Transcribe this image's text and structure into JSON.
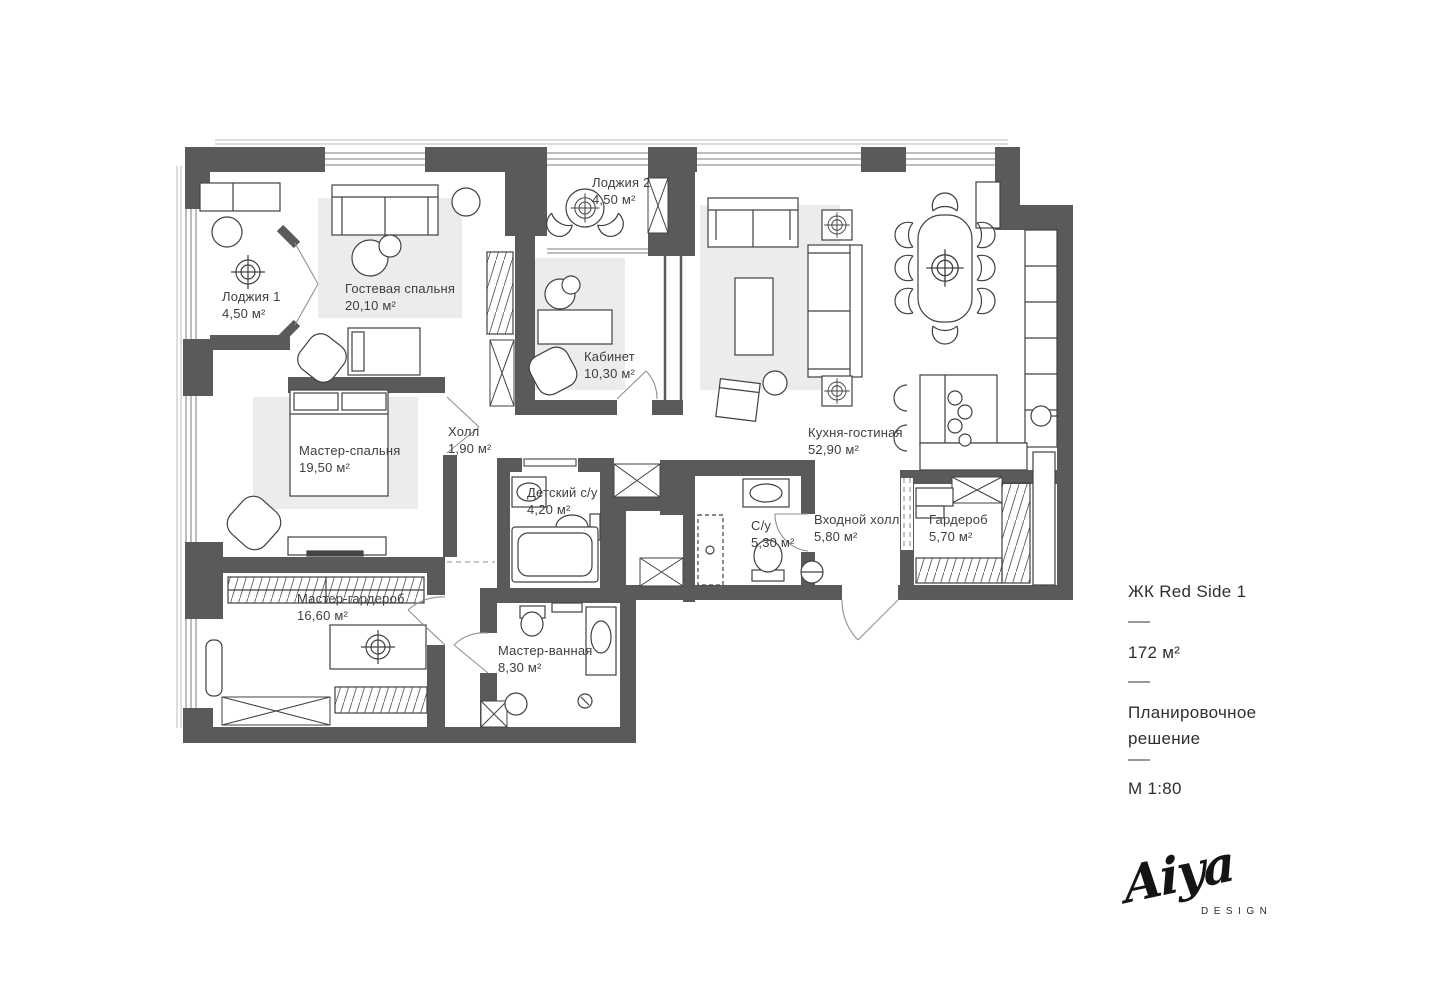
{
  "plan": {
    "rooms": [
      {
        "id": "loggia1",
        "name": "Лоджия 1",
        "area": "4,50 м²"
      },
      {
        "id": "guest_bedroom",
        "name": "Гостевая спальня",
        "area": "20,10 м²"
      },
      {
        "id": "loggia2",
        "name": "Лоджия 2",
        "area": "4,50 м²"
      },
      {
        "id": "office",
        "name": "Кабинет",
        "area": "10,30 м²"
      },
      {
        "id": "kitchen_living",
        "name": "Кухня-гостиная",
        "area": "52,90 м²"
      },
      {
        "id": "master_bedroom",
        "name": "Мастер-спальня",
        "area": "19,50 м²"
      },
      {
        "id": "hall",
        "name": "Холл",
        "area": "1,90 м²"
      },
      {
        "id": "kids_bathroom",
        "name": "Детский с/у",
        "area": "4,20 м²"
      },
      {
        "id": "bathroom",
        "name": "С/у",
        "area": "5,30 м²"
      },
      {
        "id": "entry_hall",
        "name": "Входной холл",
        "area": "5,80 м²"
      },
      {
        "id": "wardrobe",
        "name": "Гардероб",
        "area": "5,70 м²"
      },
      {
        "id": "master_wardrobe",
        "name": "Мастер-гардероб",
        "area": "16,60 м²"
      },
      {
        "id": "master_bathroom",
        "name": "Мастер-ванная",
        "area": "8,30 м²"
      }
    ]
  },
  "info_panel": {
    "project": "ЖК Red Side 1",
    "total_area": "172 м²",
    "doc_type": "Планировочное решение",
    "scale": "М 1:80"
  },
  "logo": {
    "brand": "Aiya",
    "caption": "DESIGN"
  },
  "colors": {
    "wall": "#595a5c",
    "rug": "#ebecec",
    "furniture_line": "#414141",
    "light_line": "#8f9092",
    "text": "#3d3e40"
  }
}
